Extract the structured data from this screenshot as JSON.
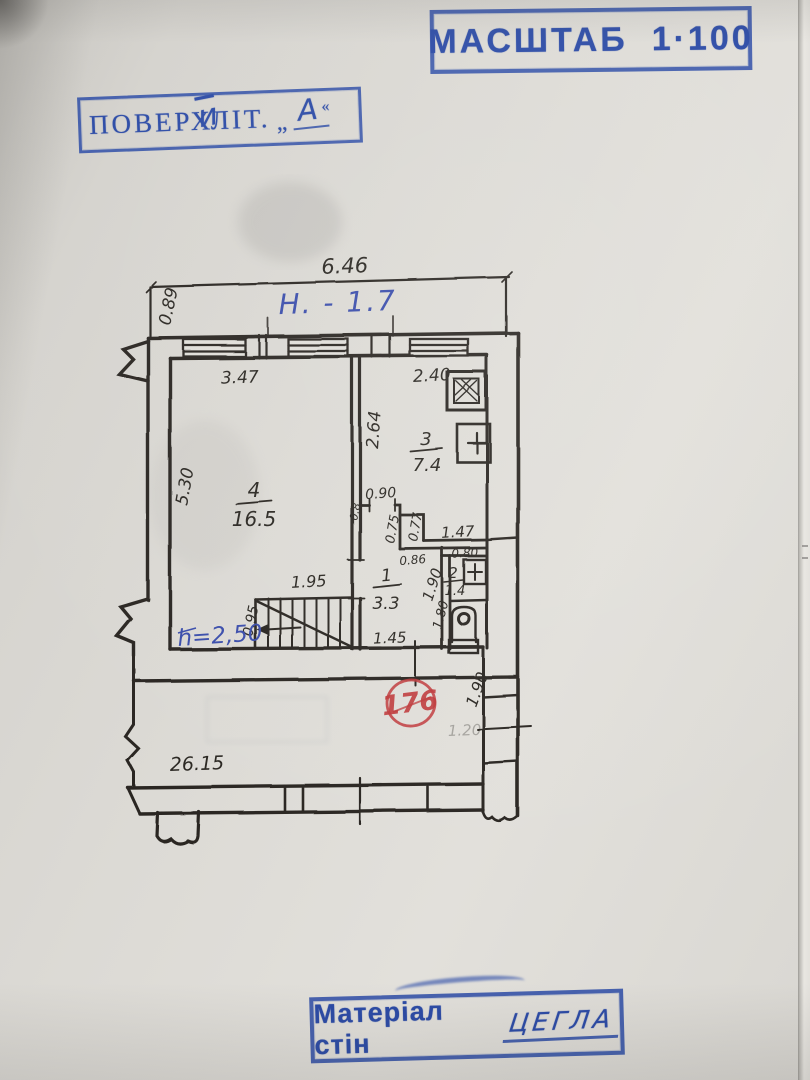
{
  "stamps": {
    "scale": {
      "label": "МАСШТАБ",
      "value": "1·100"
    },
    "floor": {
      "label": "ПОВЕРХ",
      "overwrite": "и",
      "lit": "ЛІТ.",
      "open_quote": "„",
      "letter": "А",
      "close_quote": "«"
    },
    "material": {
      "label": "Матеріал стін",
      "value": "ЦЕГЛА"
    }
  },
  "annotations": {
    "height_mark": "Н. - 1.7",
    "ceiling_height": "h=2,50",
    "registry_number": "176",
    "bleed_note": "1.20"
  },
  "rooms": [
    {
      "num": "4",
      "area": "16.5"
    },
    {
      "num": "3",
      "area": "7.4"
    },
    {
      "num": "1",
      "area": "3.3"
    },
    {
      "num": "2",
      "area": "1.4"
    }
  ],
  "dims": {
    "top_width": "6.46",
    "balcony_side": "0.89",
    "room4_w": "3.47",
    "kitchen_w": "2.40",
    "room4_h": "5.30",
    "kitchen_h": "2.64",
    "hall_door": "0.90",
    "niche_side": "0.8",
    "niche_a": "0.75",
    "niche_b": "0.77",
    "kitchen_lower": "1.47",
    "hall_top": "0.86",
    "hall_depth": "1.90",
    "bath_w": "0.80",
    "wc_depth": "1.80",
    "stairs_opening": "1.95",
    "stairs_w": "0.95",
    "hall_bottom": "1.45",
    "building_len": "26.15",
    "right_wing": "1.90"
  },
  "colors": {
    "stamp_blue": "#2c4ba6",
    "pen_blue": "#3a4dab",
    "stamp_red": "#bf3a3c",
    "ink": "#2a2722",
    "paper": "#dcdad5"
  }
}
